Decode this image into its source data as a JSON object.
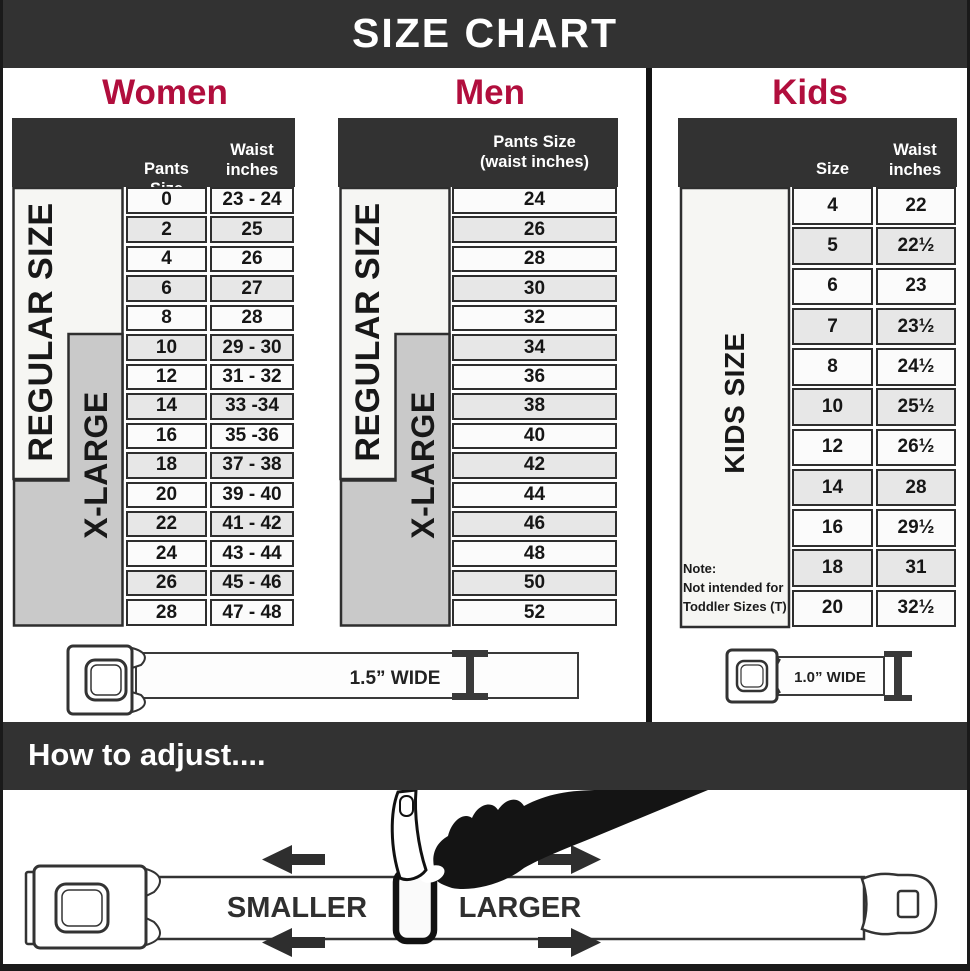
{
  "banner": {
    "title": "SIZE CHART"
  },
  "women": {
    "title": "Women",
    "header": {
      "col1": "Pants Size",
      "col2_line1": "Waist",
      "col2_line2": "inches"
    },
    "labels": {
      "regular": "REGULAR SIZE",
      "xlarge": "X-LARGE"
    },
    "rows": [
      {
        "size": "0",
        "waist": "23 - 24"
      },
      {
        "size": "2",
        "waist": "25"
      },
      {
        "size": "4",
        "waist": "26"
      },
      {
        "size": "6",
        "waist": "27"
      },
      {
        "size": "8",
        "waist": "28"
      },
      {
        "size": "10",
        "waist": "29 - 30"
      },
      {
        "size": "12",
        "waist": "31 - 32"
      },
      {
        "size": "14",
        "waist": "33 -34"
      },
      {
        "size": "16",
        "waist": "35 -36"
      },
      {
        "size": "18",
        "waist": "37 - 38"
      },
      {
        "size": "20",
        "waist": "39 - 40"
      },
      {
        "size": "22",
        "waist": "41 - 42"
      },
      {
        "size": "24",
        "waist": "43 - 44"
      },
      {
        "size": "26",
        "waist": "45 - 46"
      },
      {
        "size": "28",
        "waist": "47 - 48"
      }
    ],
    "belt_label": "1.5” WIDE"
  },
  "men": {
    "title": "Men",
    "header": {
      "line1": "Pants Size",
      "line2": "(waist inches)"
    },
    "labels": {
      "regular": "REGULAR SIZE",
      "xlarge": "X-LARGE"
    },
    "rows": [
      "24",
      "26",
      "28",
      "30",
      "32",
      "34",
      "36",
      "38",
      "40",
      "42",
      "44",
      "46",
      "48",
      "50",
      "52"
    ]
  },
  "kids": {
    "title": "Kids",
    "header": {
      "col1": "Size",
      "col2_line1": "Waist",
      "col2_line2": "inches"
    },
    "labels": {
      "kids": "KIDS SIZE"
    },
    "note": {
      "line1": "Note:",
      "line2": "Not intended for",
      "line3": "Toddler Sizes (T)"
    },
    "rows": [
      {
        "size": "4",
        "waist": "22"
      },
      {
        "size": "5",
        "waist": "22½"
      },
      {
        "size": "6",
        "waist": "23"
      },
      {
        "size": "7",
        "waist": "23½"
      },
      {
        "size": "8",
        "waist": "24½"
      },
      {
        "size": "10",
        "waist": "25½"
      },
      {
        "size": "12",
        "waist": "26½"
      },
      {
        "size": "14",
        "waist": "28"
      },
      {
        "size": "16",
        "waist": "29½"
      },
      {
        "size": "18",
        "waist": "31"
      },
      {
        "size": "20",
        "waist": "32½"
      }
    ],
    "belt_label": "1.0” WIDE"
  },
  "adjust": {
    "title": "How to adjust....",
    "smaller": "SMALLER",
    "larger": "LARGER"
  },
  "colors": {
    "accent": "#b10e3d",
    "dark": "#323232",
    "row_alt": "#e7e7e7"
  }
}
